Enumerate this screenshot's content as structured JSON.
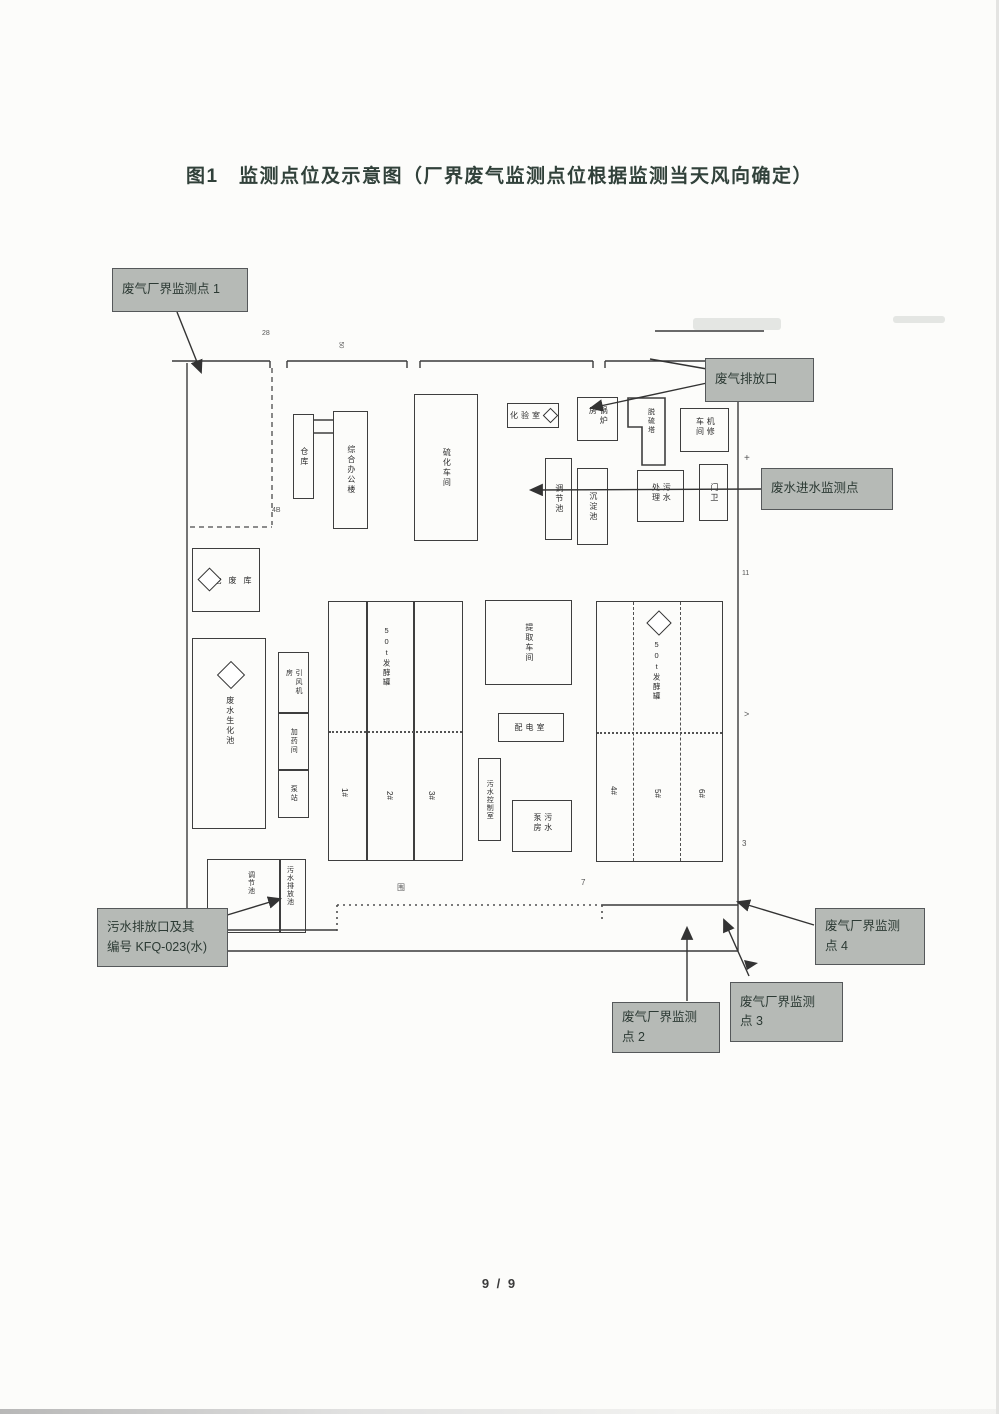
{
  "title": "图1　监测点位及示意图（厂界废气监测点位根据监测当天风向确定）",
  "page_number": "9 / 9",
  "callouts": {
    "point1": "废气厂界监测点 1",
    "gas_outlet": "废气排放口",
    "wastewater_inlet": "废水进水监测点",
    "sewage_outlet": [
      "污水排放口及其",
      "编号 KFQ-023(水)"
    ],
    "point2": [
      "废气厂界监测",
      "点 2"
    ],
    "point3": [
      "废气厂界监测",
      "点 3"
    ],
    "point4": [
      "废气厂界监测",
      "点 4"
    ]
  },
  "buildings": {
    "warehouse": "仓库",
    "office": "综合办公楼",
    "vulcanization_workshop": "硫化车间",
    "lab": "化验室",
    "boiler": "锅炉房",
    "desulfurization_tower": "脱硫塔",
    "maintenance": "机修车间",
    "regulating_tank": "调节池",
    "sedimentation_tank": "沉淀池",
    "sewage_treatment": "污水处理",
    "gatehouse": "门卫",
    "hazardous_waste": "危废库",
    "biochemical_tank": "废水生化池",
    "fan_room": "引风机房",
    "dosing_room": "加药间",
    "pump_station": "泵站",
    "fermenter_left": "50t发酵罐",
    "fermenter_right": "50t发酵罐",
    "strips_left": [
      "1#",
      "2#",
      "3#"
    ],
    "strips_right": [
      "4#",
      "5#",
      "6#"
    ],
    "extraction_workshop": "提取车间",
    "power_room": "配电室",
    "control_room": "污水控制室",
    "sewage_pump_room": "污水泵房",
    "pond_left": "调节池",
    "pond_right": "污水排放池"
  },
  "marks": {
    "m1": "28",
    "m2": "50",
    "m3": "+",
    "m4": "11",
    "m5": ">",
    "m6": "3",
    "m7": "围",
    "m8": "7",
    "m9": "4B"
  },
  "colors": {
    "callout_bg": "#b6bab6",
    "callout_border": "#55585a",
    "line": "#3a3a3a",
    "title_text": "#31413a"
  }
}
